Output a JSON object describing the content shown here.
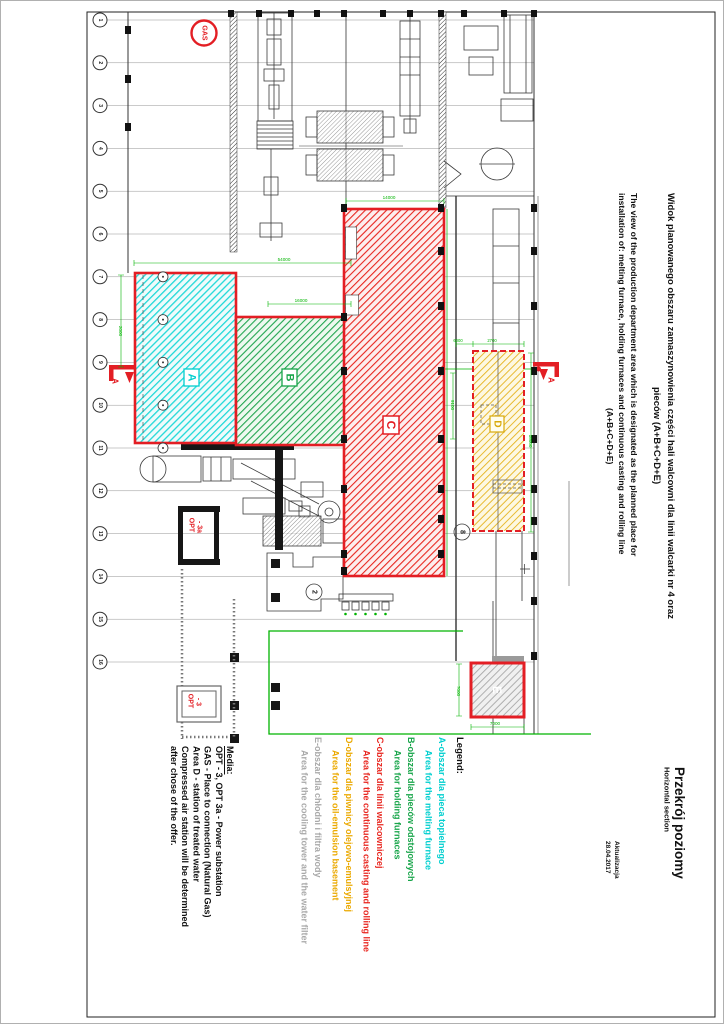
{
  "titles": {
    "pl_line1": "Widok planowanego obszaru zamaszynowienia części hali walcowni dla linii walcarki nr 4 oraz",
    "pl_line2": "pieców  (A+B+C+D+E)",
    "en_line1": "The view of the production department area which is designated as the planned place for",
    "en_line2": "installation of: melting furnace, holding furnaces and continuous casting and rolling line",
    "en_line3": "(A+B+C+D+E)"
  },
  "section_title": {
    "pl": "Przekrój poziomy",
    "en": "Horizontal section"
  },
  "update": {
    "label": "Aktualizacja",
    "date": "28.04.2017"
  },
  "legend": {
    "heading": "Legend:",
    "entries": [
      {
        "id": "A",
        "color": "#00cfcf",
        "pl": "A-obszar dla pieca topielnego",
        "en": "Area for the melting furnace"
      },
      {
        "id": "B",
        "color": "#18a54a",
        "pl": "B-obszar dla pieców odstojowych",
        "en": "Area for holding furnaces"
      },
      {
        "id": "C",
        "color": "#e8261f",
        "pl": "C-obszar dla linii walcowniczej",
        "en": "Area for the continuous casting and rolling line"
      },
      {
        "id": "D",
        "color": "#eba900",
        "pl": "D-obszar dla piwnicy olejowo-emulsyjnej",
        "en": "Area for the oil-emulsion basement"
      },
      {
        "id": "E",
        "color": "#a9a9a9",
        "pl": "E-obszar dla chłodni i filtra wody",
        "en": "Area for the cooling tower and the water filter"
      }
    ]
  },
  "media": {
    "heading": "Media:",
    "lines": [
      "OPT - 3, OPT 3a - Power substation",
      "GAS - Place to connection (Natural Gas)",
      "Area D - station of treated water",
      "Compressed air station will be determined",
      "after chose of the offer."
    ]
  },
  "plan": {
    "gas_label": "GAS",
    "opt3a": [
      "OPT",
      "- 3a"
    ],
    "opt3": [
      "OPT",
      "- 3"
    ],
    "areas": {
      "a": "A",
      "b": "B",
      "c": "C",
      "d": "D",
      "e": "E"
    },
    "section_mark": "A",
    "axis_rows": [
      "1",
      "2",
      "3",
      "4",
      "5",
      "6",
      "7",
      "8",
      "9",
      "10",
      "11",
      "12",
      "13",
      "14",
      "15",
      "16"
    ],
    "circled_markers": [
      "2",
      "8"
    ],
    "dims": {
      "hall_width": "54000",
      "b_width": "16000",
      "c_width": "14000",
      "gap": "6000",
      "d_width": "2700",
      "c_len": "9100",
      "d_len": "18000",
      "e_width": "7000",
      "e_len": "7000",
      "a_dim": "2000"
    },
    "colors": {
      "area_border": "#e31e24",
      "dim_green": "#00b400"
    }
  }
}
